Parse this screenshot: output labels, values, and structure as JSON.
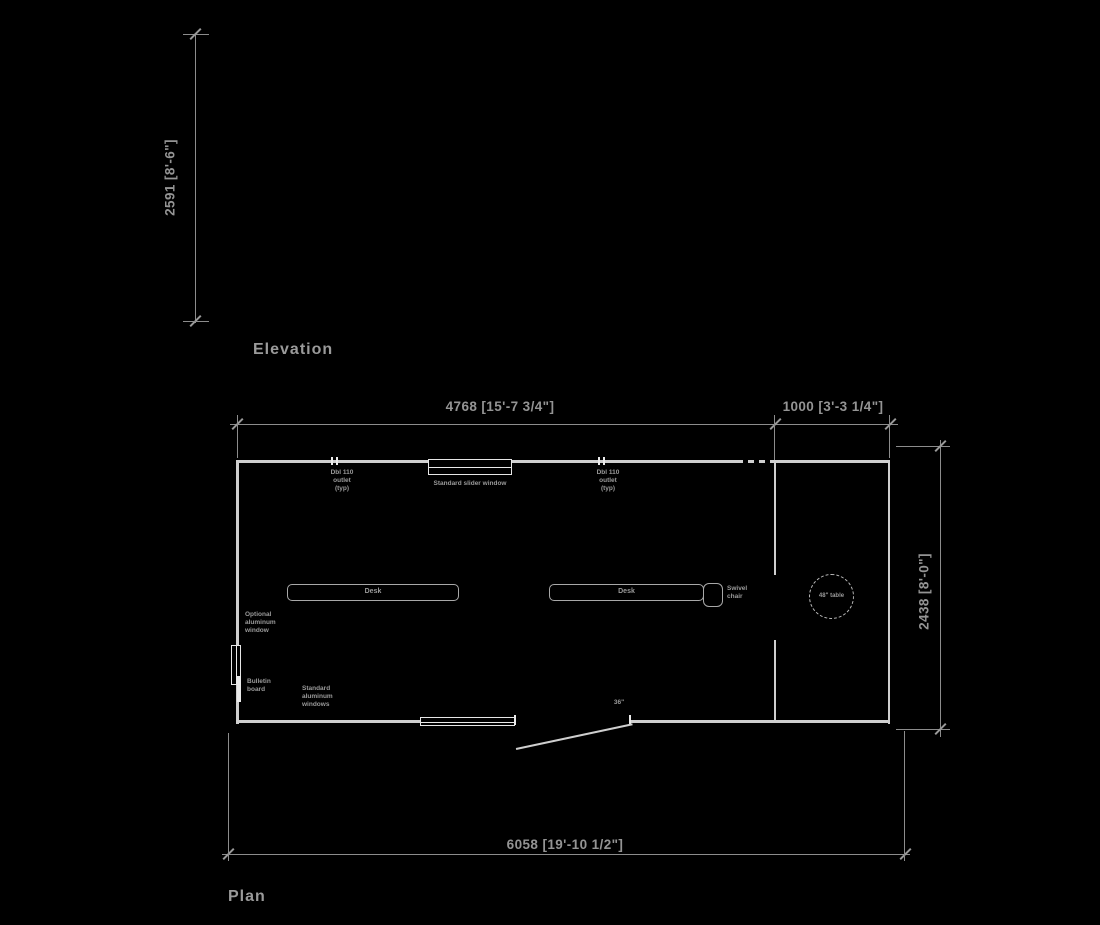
{
  "colors": {
    "background": "#000000",
    "dimension_lines": "#8c8c8c",
    "drawing_lines": "#cfcfcf",
    "window_lines": "#eaeaea",
    "text": "#9a9a9a"
  },
  "views": {
    "elevation": {
      "title": "Elevation",
      "dim_height": "2591 [8'-6\"]"
    },
    "plan": {
      "title": "Plan",
      "dim_top_left": "4768 [15'-7 3/4\"]",
      "dim_top_right": "1000 [3'-3 1/4\"]",
      "dim_right": "2438 [8'-0\"]",
      "dim_bottom": "6058 [19'-10 1/2\"]",
      "outlet_label": {
        "l1": "Dbl 110",
        "l2": "outlet",
        "l3": "(typ)"
      },
      "window_top_label": "Standard slider window",
      "desk_label": "Desk",
      "chair_label": {
        "l1": "Swivel",
        "l2": "chair"
      },
      "table_label": "48\" table",
      "left_window_label": {
        "l1": "Optional",
        "l2": "aluminum",
        "l3": "window"
      },
      "bottom_window_label": {
        "l1": "Standard",
        "l2": "aluminum",
        "l3": "windows"
      },
      "bulletin_label": {
        "l1": "Bulletin",
        "l2": "board"
      },
      "door_label": "36\""
    }
  }
}
